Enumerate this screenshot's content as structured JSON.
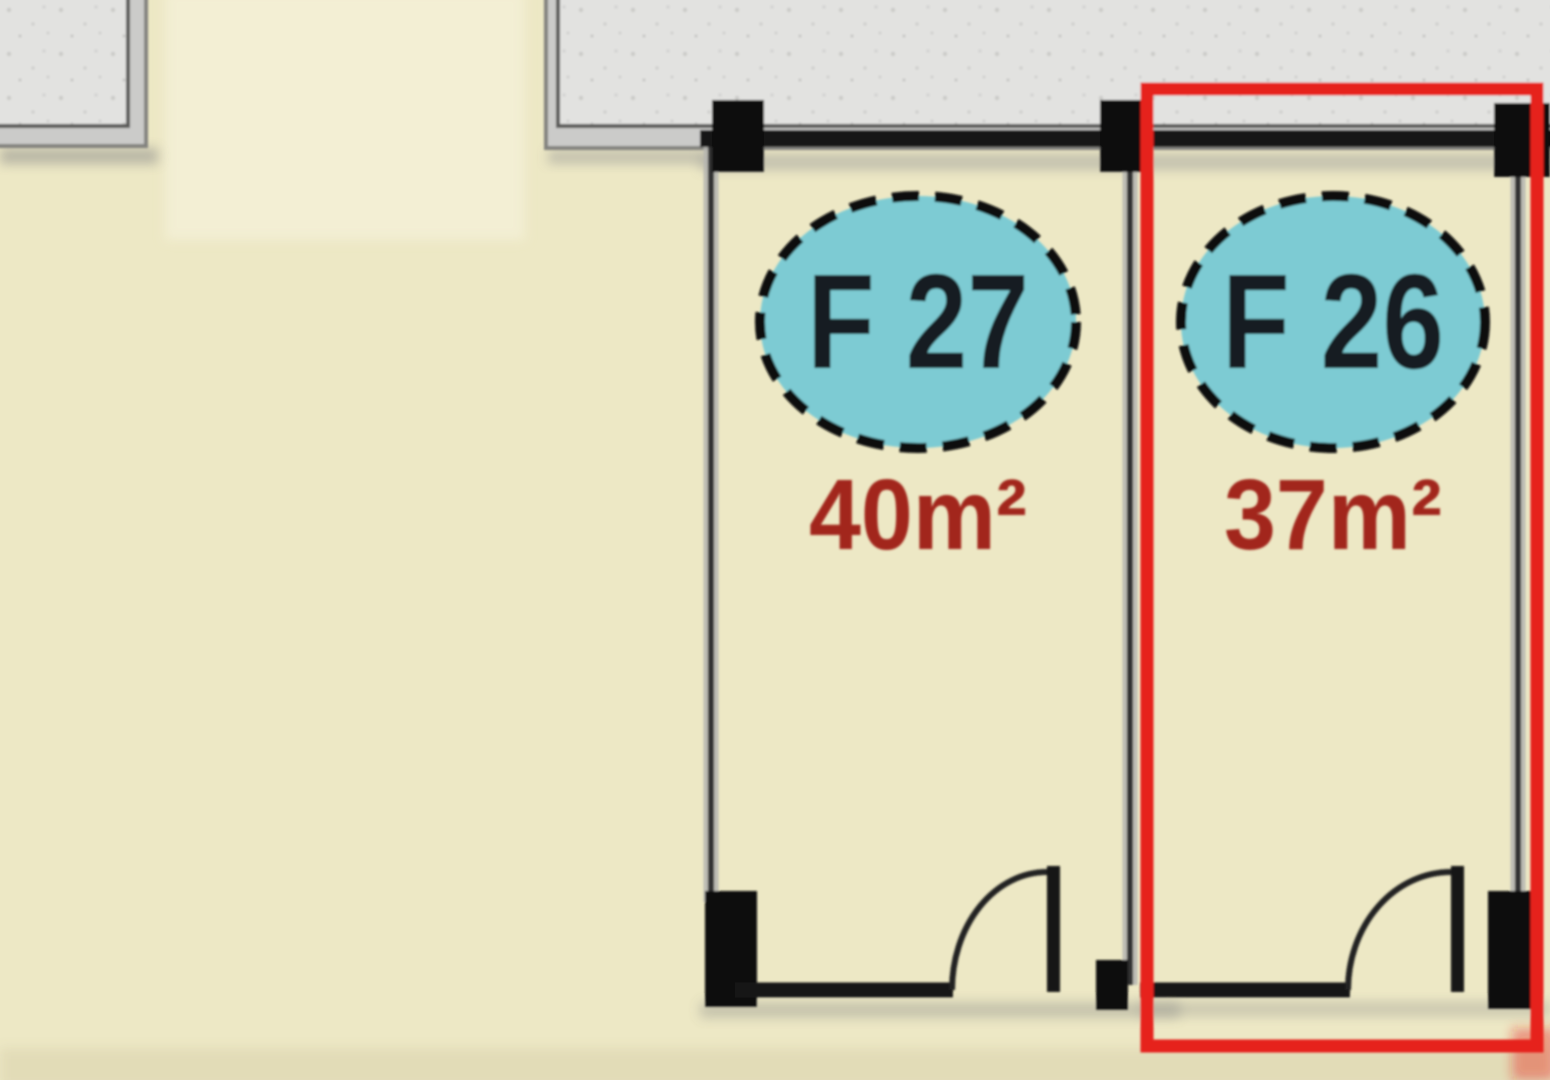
{
  "plan": {
    "selected_unit": "F 26",
    "units": [
      {
        "id": "unit-f27",
        "label": "F 27",
        "area": "40m²",
        "selected": false
      },
      {
        "id": "unit-f26",
        "label": "F 26",
        "area": "37m²",
        "selected": true
      }
    ]
  },
  "palette": {
    "background": "#EDE8C5",
    "corridor_fill": "#E2E2E0",
    "corridor_frame": "#CBCBC9",
    "corridor_border": "#5A5A58",
    "wall": "#161616",
    "badge_fill": "#7DCBD3",
    "badge_border": "#0D0D0D",
    "unit_label_color": "#121B22",
    "area_label_color": "#A2251C",
    "highlight": "#E6201E"
  }
}
